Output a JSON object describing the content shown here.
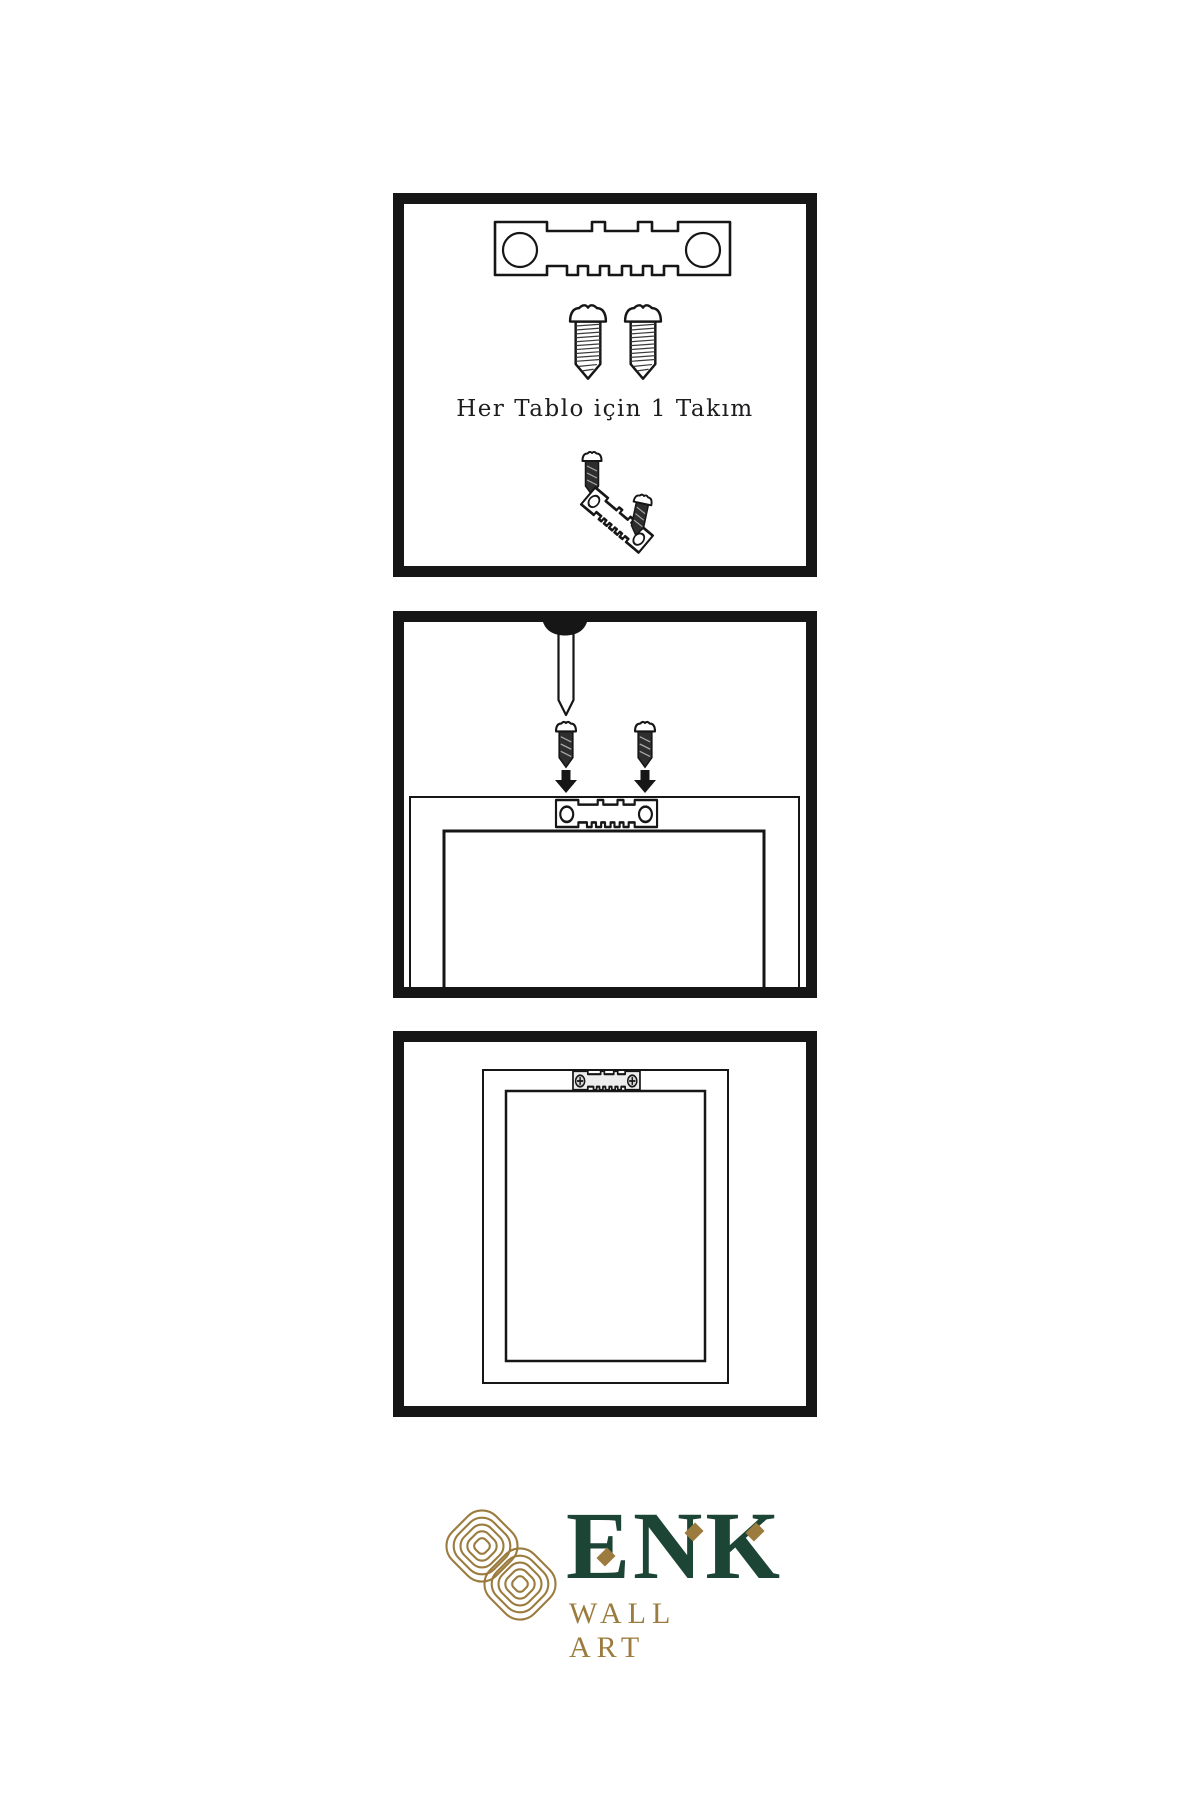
{
  "colors": {
    "ink": "#161616",
    "green": "#1d4536",
    "gold": "#9b7c3e",
    "screw": "#2e2e2e"
  },
  "step1": {
    "caption": "Her Tablo için 1 Takım"
  },
  "brand": {
    "name": "ENK",
    "subtitle": "WALL ART"
  },
  "icons": {
    "sawtooth-hanger-icon": "metal sawtooth hanger plate with two screw holes",
    "screw-icon": "wood screw, side view with threads",
    "dark-screw-icon": "dark threaded screw",
    "nail-icon": "nail driven into wall from top edge",
    "arrow-down-icon": "▼",
    "phillips-screw-icon": "⊕",
    "frame-icon": "picture frame back view",
    "knot-icon": "interlaced gold knot monogram"
  }
}
